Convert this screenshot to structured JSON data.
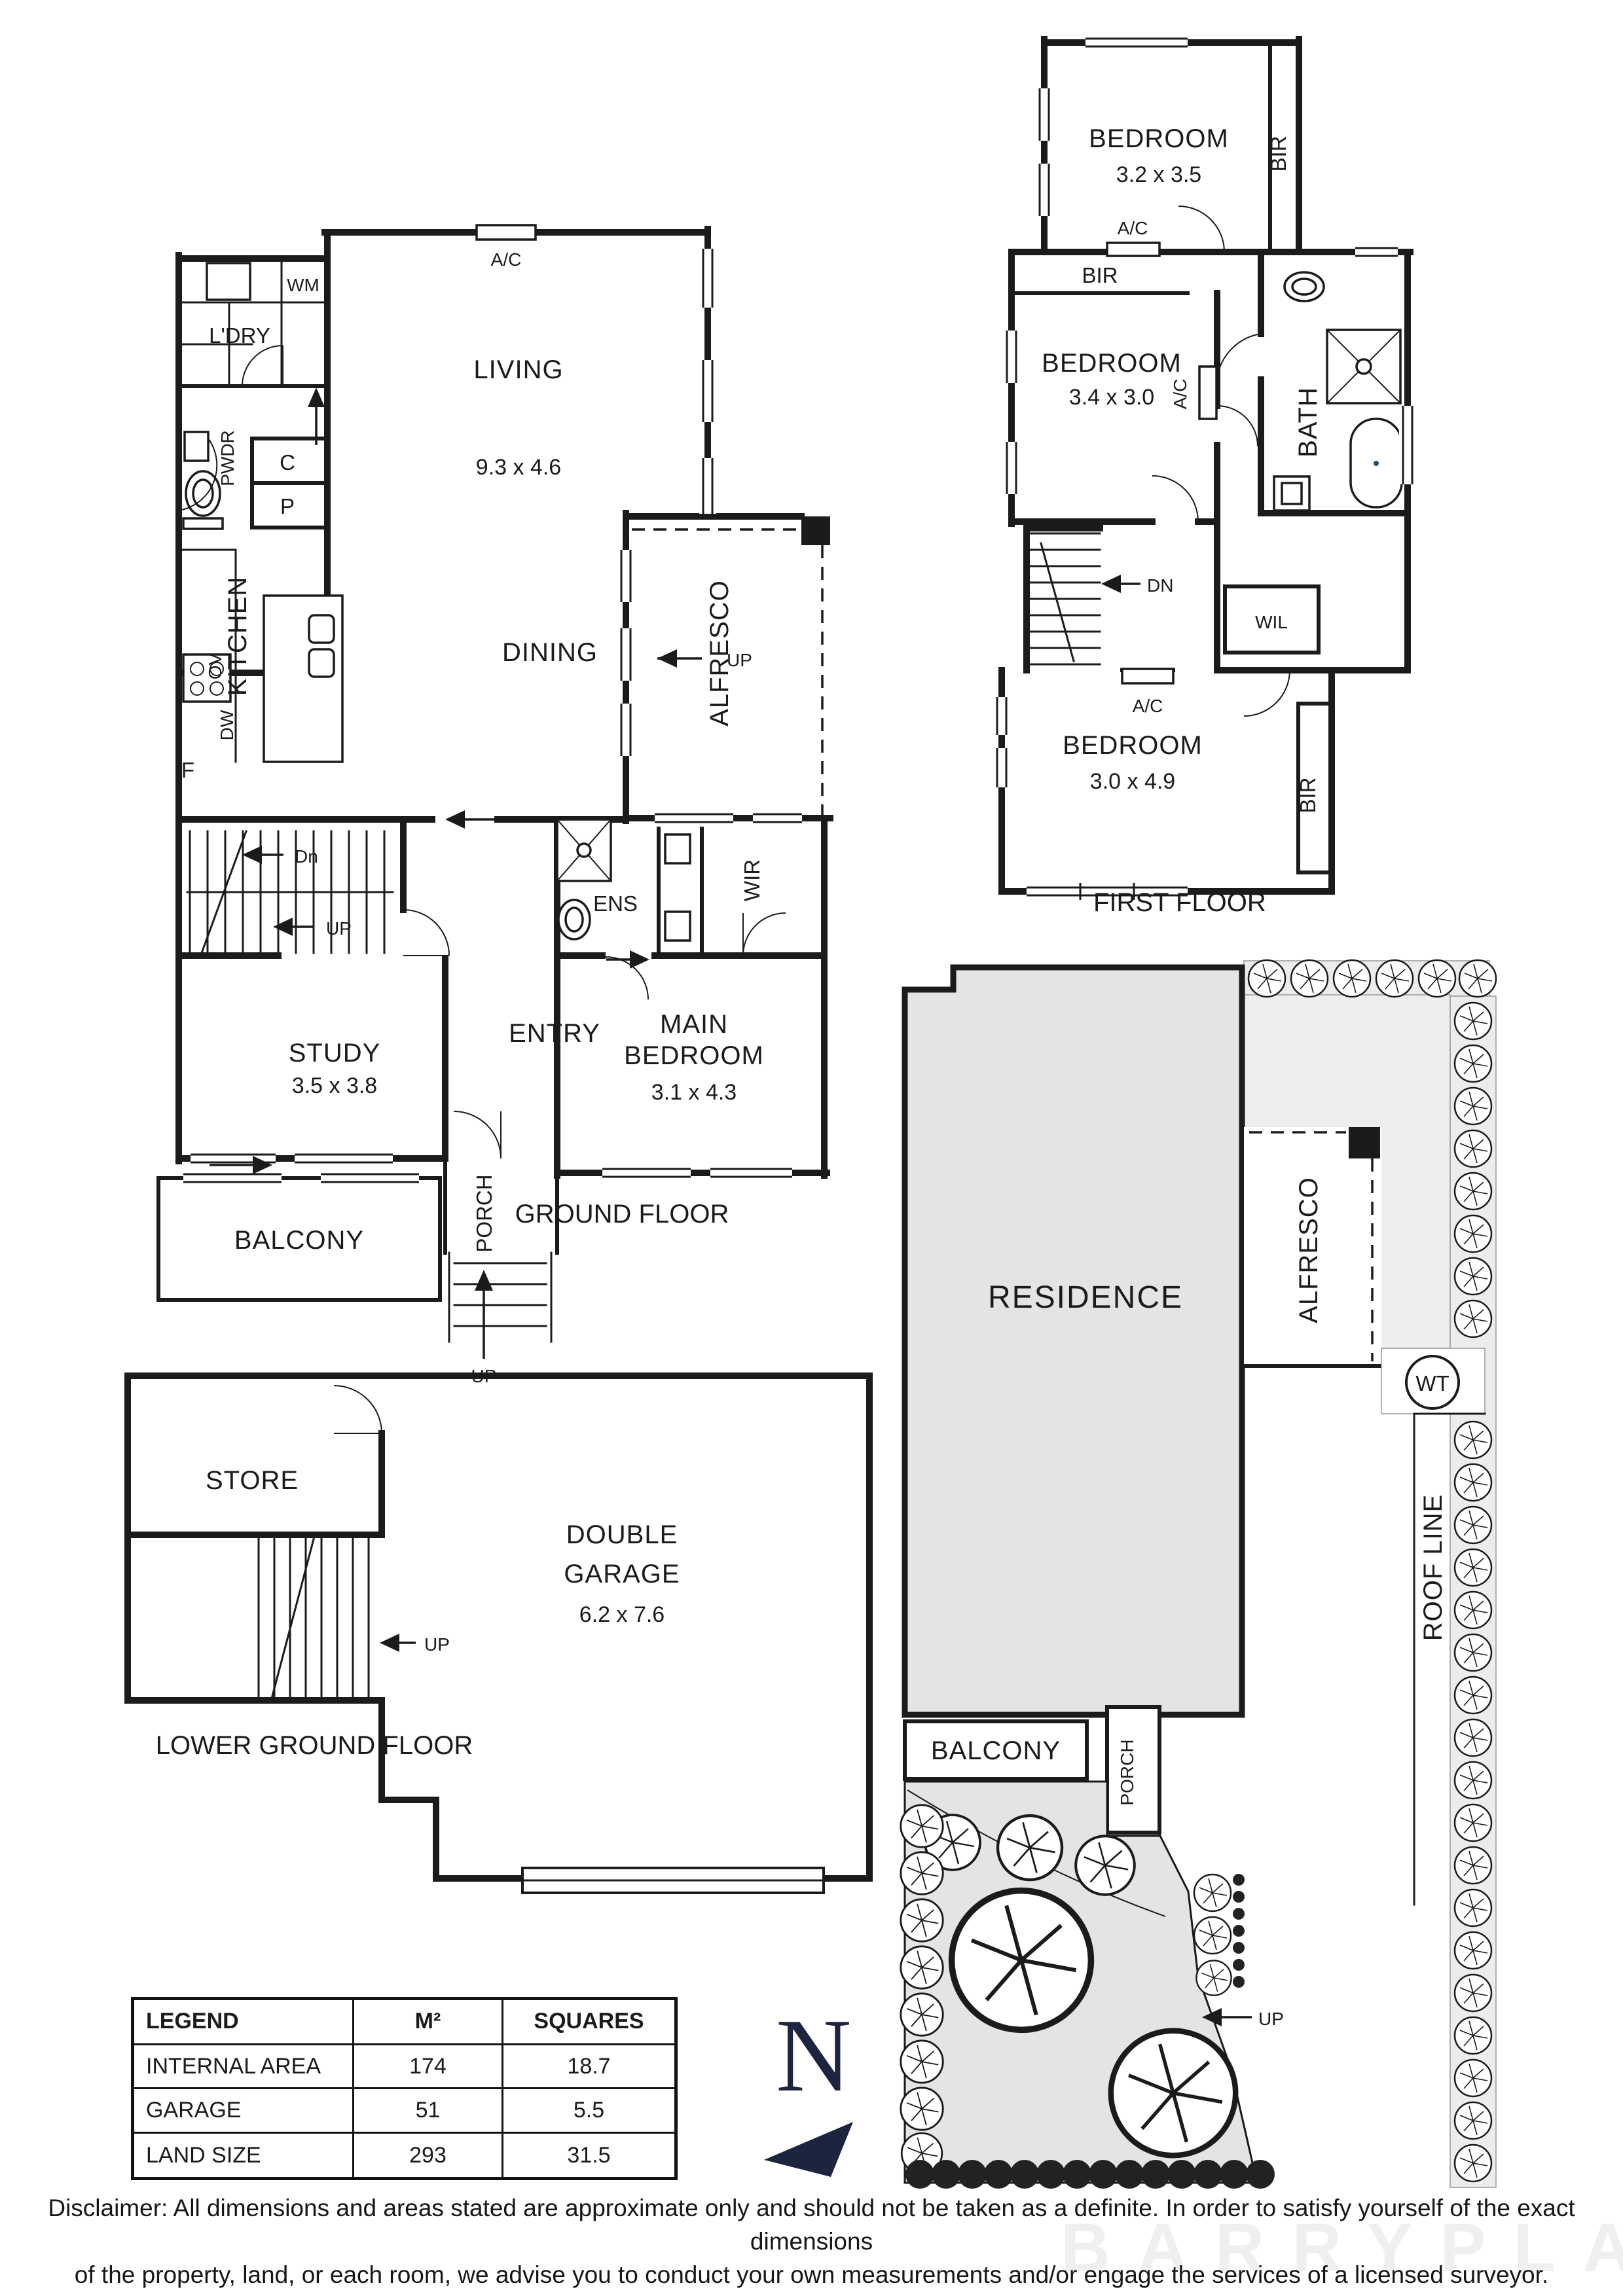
{
  "labels": {
    "ac": "A/C",
    "up": "UP",
    "dn": "Dn",
    "dn_caps": "DN",
    "bir": "BIR",
    "wm": "WM",
    "ldry": "L'DRY",
    "pwdr": "PWDR",
    "c": "C",
    "p": "P",
    "f": "F",
    "ov": "OV",
    "dw": "DW",
    "kitchen": "KITCHEN",
    "living": "LIVING",
    "living_dim": "9.3 x 4.6",
    "dining": "DINING",
    "alfresco": "ALFRESCO",
    "wir": "WIR",
    "ens": "ENS",
    "entry": "ENTRY",
    "study": "STUDY",
    "study_dim": "3.5 x 3.8",
    "main1": "MAIN",
    "main2": "BEDROOM",
    "main_dim": "3.1 x 4.3",
    "balcony": "BALCONY",
    "porch": "PORCH",
    "ground_title": "GROUND FLOOR",
    "bedroom": "BEDROOM",
    "bed1_dim": "3.2 x 3.5",
    "bed2_dim": "3.4 x 3.0",
    "bed3_dim": "3.0 x 4.9",
    "bath": "BATH",
    "wil": "WIL",
    "first_title": "FIRST FLOOR",
    "store": "STORE",
    "garage1": "DOUBLE",
    "garage2": "GARAGE",
    "garage_dim": "6.2 x 7.6",
    "lower_title": "LOWER GROUND FLOOR",
    "residence": "RESIDENCE",
    "roof_line": "ROOF LINE",
    "wt": "WT",
    "north": "N"
  },
  "legend": {
    "headers": [
      "LEGEND",
      "M²",
      "SQUARES"
    ],
    "rows": [
      [
        "INTERNAL AREA",
        "174",
        "18.7"
      ],
      [
        "GARAGE",
        "51",
        "5.5"
      ],
      [
        "LAND SIZE",
        "293",
        "31.5"
      ]
    ]
  },
  "disclaimer": {
    "line1": "Disclaimer: All dimensions and areas stated are approximate only and should not be taken as a definite. In order to satisfy yourself of the exact dimensions",
    "line2": "of the property, land, or each room, we advise you to conduct your own measurements and/or engage the services of a licensed surveyor. Responsibility",
    "line3": "for any omissions or errors contained herein is expressly denied."
  },
  "watermark": "BARRYPLANT",
  "colors": {
    "wall": "#1b1b1b",
    "fill_gray": "#e4e4e4",
    "fill_light": "#ededed",
    "north": "#1d2440"
  }
}
